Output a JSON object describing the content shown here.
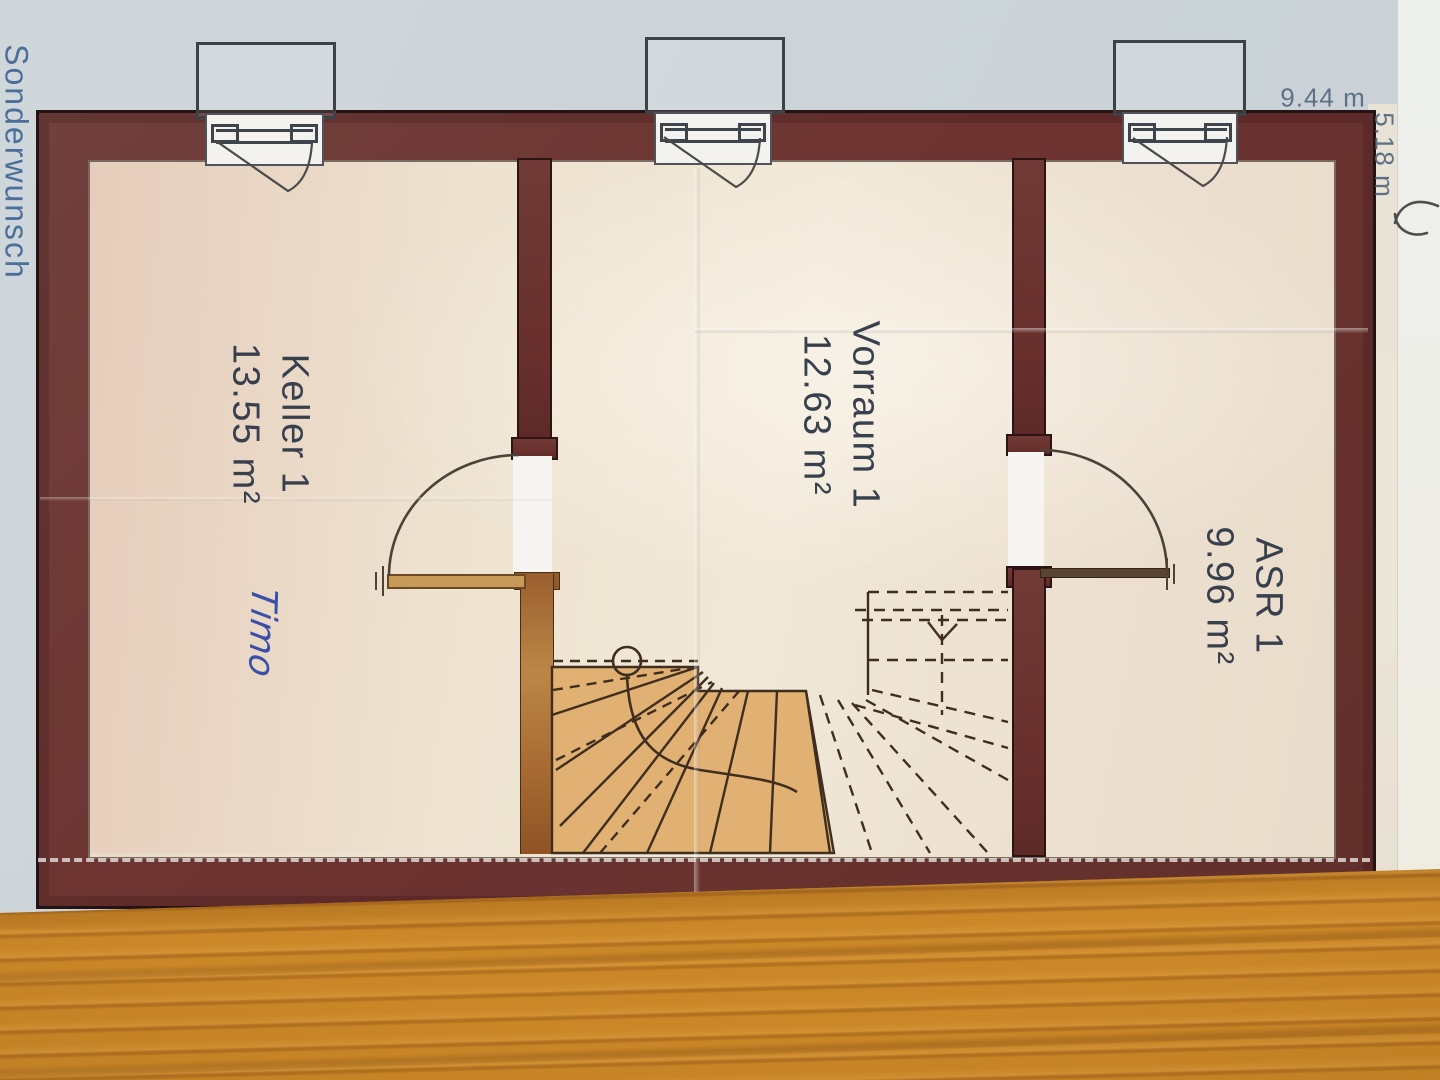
{
  "plan": {
    "margin_label": "Sonderwunsch",
    "dimensions": {
      "width": "9.44 m",
      "depth": "5.18 m"
    },
    "rooms": [
      {
        "name": "Keller 1",
        "area": "13.55 m²"
      },
      {
        "name": "Vorraum 1",
        "area": "12.63 m²"
      },
      {
        "name": "ASR 1",
        "area": "9.96 m²"
      }
    ],
    "handwritten_note": "Timo"
  },
  "colors": {
    "label-ink": "#38404e",
    "dim-ink": "#5e7085",
    "margin-ink": "#4b6f9a",
    "note-ink": "#3a4fa8",
    "wall": "#6d3331",
    "stair-tan": "#e0b173",
    "copper-wall": "#a96f3a",
    "plan-line": "#3f2e1e",
    "paper-blue": "#ccd4d9",
    "paper-cream": "#ece5d6",
    "wood": "#cf8c2d"
  }
}
